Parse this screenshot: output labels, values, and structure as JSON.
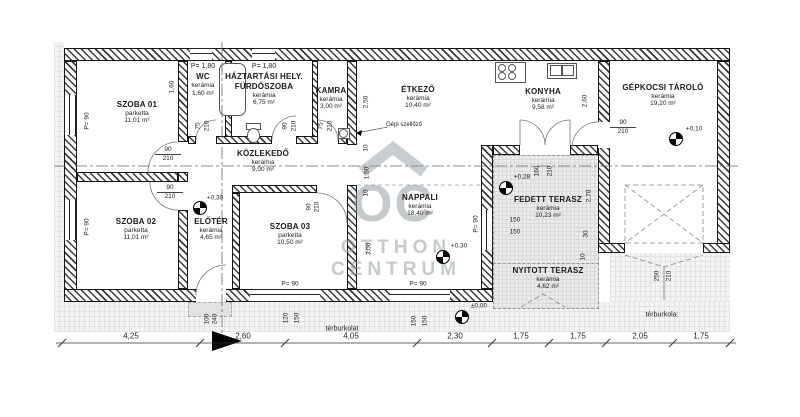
{
  "watermark": {
    "logo": "OC",
    "line1": "OTTHON",
    "line2": "CENTRUM"
  },
  "rooms": [
    {
      "name": "SZOBA 01",
      "floor": "parketta",
      "area": "11,01 m²"
    },
    {
      "name": "WC",
      "floor": "kerámia",
      "area": "1,60 m²",
      "note": "P= 1,80"
    },
    {
      "name": "HÁZTARTÁSI HELY.",
      "name2": "FÜRDŐSZOBA",
      "floor": "kerámia",
      "area": "6,75 m²",
      "note": "P= 1,80"
    },
    {
      "name": "KAMRA",
      "floor": "kerámia",
      "area": "3,00 m²"
    },
    {
      "name": "ÉTKEZŐ",
      "floor": "kerámia",
      "area": "10,40 m²"
    },
    {
      "name": "KONYHA",
      "floor": "kerámia",
      "area": "9,58 m²"
    },
    {
      "name": "GÉPKOCSI TÁROLÓ",
      "floor": "kerámia",
      "area": "19,20 m²"
    },
    {
      "name": "KÖZLEKEDŐ",
      "floor": "kerámia",
      "area": "9,00 m²"
    },
    {
      "name": "SZOBA 02",
      "floor": "parketta",
      "area": "11,01 m²"
    },
    {
      "name": "ELŐTÉR",
      "floor": "kerámia",
      "area": "4,65 m²"
    },
    {
      "name": "SZOBA 03",
      "floor": "parketta",
      "area": "10,50 m²"
    },
    {
      "name": "NAPPALI",
      "floor": "kerámia",
      "area": "18,40 m²"
    },
    {
      "name": "FEDETT TERASZ",
      "floor": "kerámia",
      "area": "10,23 m²"
    },
    {
      "name": "NYITOTT TERASZ",
      "floor": "kerámia",
      "area": "4,62 m²"
    }
  ],
  "dims": [
    "1,60",
    "75",
    "210",
    "90",
    "210",
    "75",
    "210",
    "2,50",
    "2,60",
    "90",
    "210",
    "160",
    "210",
    "2,70",
    "30",
    "10",
    "150",
    "150",
    "1,50",
    "10",
    "10",
    "3,00",
    "90",
    "210",
    "90",
    "210",
    "90",
    "210",
    "100",
    "240",
    "120",
    "150",
    "150",
    "150",
    "250",
    "210",
    "P= 90",
    "P= 90",
    "P= 90",
    "P= 90",
    "P= 90"
  ],
  "levels": [
    "+0,30",
    "+0,30",
    "+0,28",
    "+0,10",
    "±0,00"
  ],
  "bottom_dims": [
    "4,25",
    "2,60",
    "4,05",
    "2,30",
    "1,75",
    "1,75",
    "2,05",
    "1,75"
  ],
  "annotations": {
    "vent": "Gépi szellőző",
    "paving_left": "térburkolat",
    "paving_right": "térburkola:"
  }
}
